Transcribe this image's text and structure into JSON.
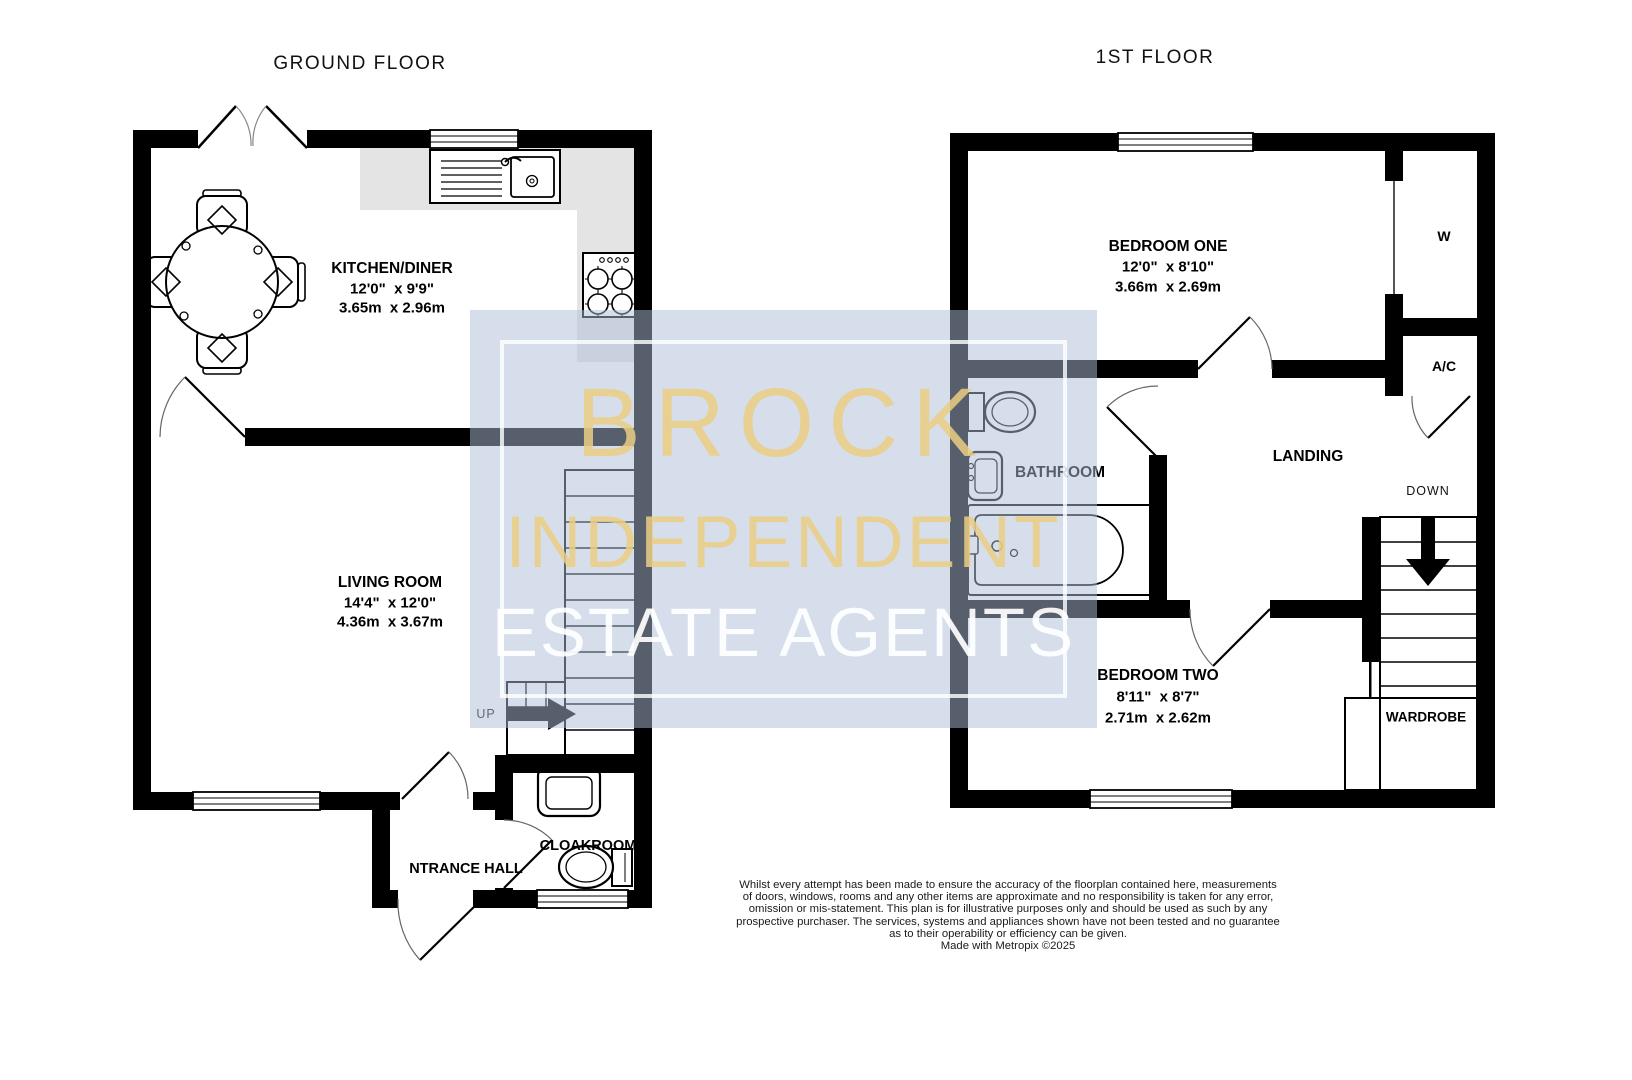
{
  "floors": {
    "ground": {
      "title": "GROUND FLOOR"
    },
    "first": {
      "title": "1ST FLOOR"
    }
  },
  "rooms": {
    "kitchen_diner": {
      "name": "KITCHEN/DINER",
      "imperial": "12'0\"  x 9'9\"",
      "metric": "3.65m  x 2.96m"
    },
    "living_room": {
      "name": "LIVING ROOM",
      "imperial": "14'4\"  x 12'0\"",
      "metric": "4.36m  x 3.67m"
    },
    "entrance_hall": {
      "name": "NTRANCE HALL"
    },
    "cloakroom": {
      "name": "CLOAKROOM"
    },
    "bedroom_one": {
      "name": "BEDROOM ONE",
      "imperial": "12'0\"  x 8'10\"",
      "metric": "3.66m  x 2.69m"
    },
    "bedroom_two": {
      "name": "BEDROOM TWO",
      "imperial": "8'11\"  x 8'7\"",
      "metric": "2.71m  x 2.62m"
    },
    "bathroom": {
      "name": "BATHROOM"
    },
    "landing": {
      "name": "LANDING"
    },
    "wardrobe": {
      "name": "WARDROBE"
    },
    "w_closet": {
      "name": "W"
    },
    "airing_cupboard": {
      "name": "A/C"
    }
  },
  "stairs": {
    "up": "UP",
    "down": "DOWN"
  },
  "watermark": {
    "line1": "BROCK",
    "line2": "INDEPENDENT",
    "line3": "ESTATE AGENTS"
  },
  "disclaimer": {
    "lines": [
      "Whilst every attempt has been made to ensure the accuracy of the floorplan contained here, measurements",
      "of doors, windows, rooms and any other items are approximate and no responsibility is taken for any error,",
      "omission or mis-statement. This plan is for illustrative purposes only and should be used as such by any",
      "prospective purchaser. The services, systems and appliances shown have not been tested and no guarantee",
      "as to their operability or efficiency can be given."
    ],
    "credit": "Made with Metropix ©2025"
  },
  "colors": {
    "wall": "#000000",
    "counter": "#e4e4e4",
    "watermark_fill": "#aec0d8",
    "watermark_gold": "#e9cd85",
    "watermark_white": "#ffffff"
  }
}
